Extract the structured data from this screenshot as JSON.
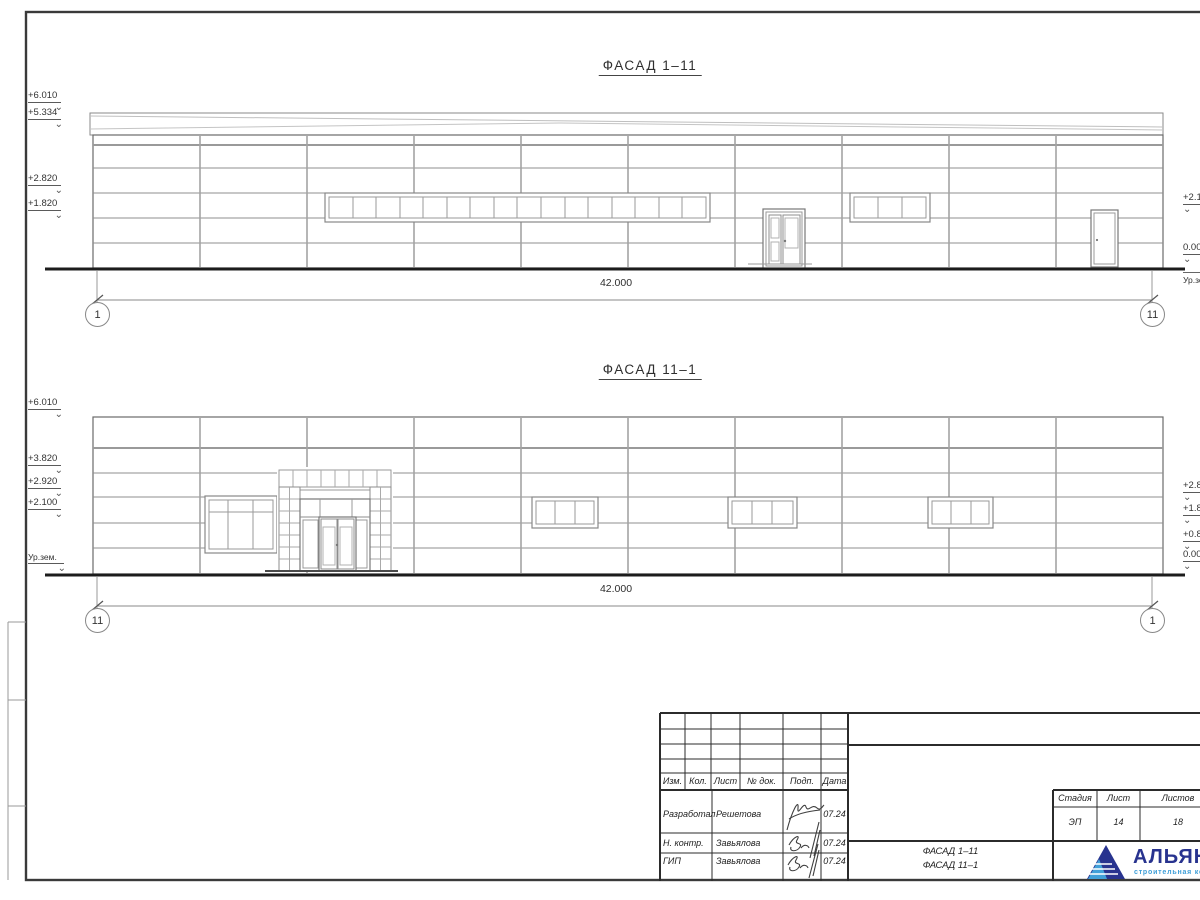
{
  "sheet": {
    "facade1": {
      "title": "ФАСАД 1–11",
      "dimension": "42.000",
      "axis_left": "1",
      "axis_right": "11",
      "marks_left": {
        "m1": "+6.010",
        "m2": "+5.334",
        "m3": "+2.820",
        "m4": "+1.820"
      },
      "marks_right": {
        "m1": "+2.100",
        "m2": "0.000",
        "m3": "Ур.зем."
      }
    },
    "facade2": {
      "title": "ФАСАД 11–1",
      "dimension": "42.000",
      "axis_left": "11",
      "axis_right": "1",
      "marks_left": {
        "m1": "+6.010",
        "m2": "+3.820",
        "m3": "+2.920",
        "m4": "+2.100",
        "m5": "Ур.зем."
      },
      "marks_right": {
        "m1": "+2.820",
        "m2": "+1.820",
        "m3": "+0.820",
        "m4": "0.000"
      }
    },
    "titleblock": {
      "header": {
        "izm": "Изм.",
        "kol": "Кол.",
        "list": "Лист",
        "doc": "№ док.",
        "podp": "Подп.",
        "data": "Дата"
      },
      "rows": [
        {
          "role": "Разработал",
          "name": "Решетова",
          "date": "07.24"
        },
        {
          "role": "Н. контр.",
          "name": "Завьялова",
          "date": "07.24"
        },
        {
          "role": "ГИП",
          "name": "Завьялова",
          "date": "07.24"
        }
      ],
      "doc_title_line1": "ФАСАД 1–11",
      "doc_title_line2": "ФАСАД 11–1",
      "stage_label": "Стадия",
      "sheet_label": "Лист",
      "sheets_label": "Листов",
      "stage_value": "ЭП",
      "sheet_value": "14",
      "sheets_value": "18"
    },
    "logo": {
      "name": "АЛЬЯНС",
      "tagline": "строительная компания",
      "navy": "#28338f",
      "light_blue": "#42a0d8"
    }
  }
}
